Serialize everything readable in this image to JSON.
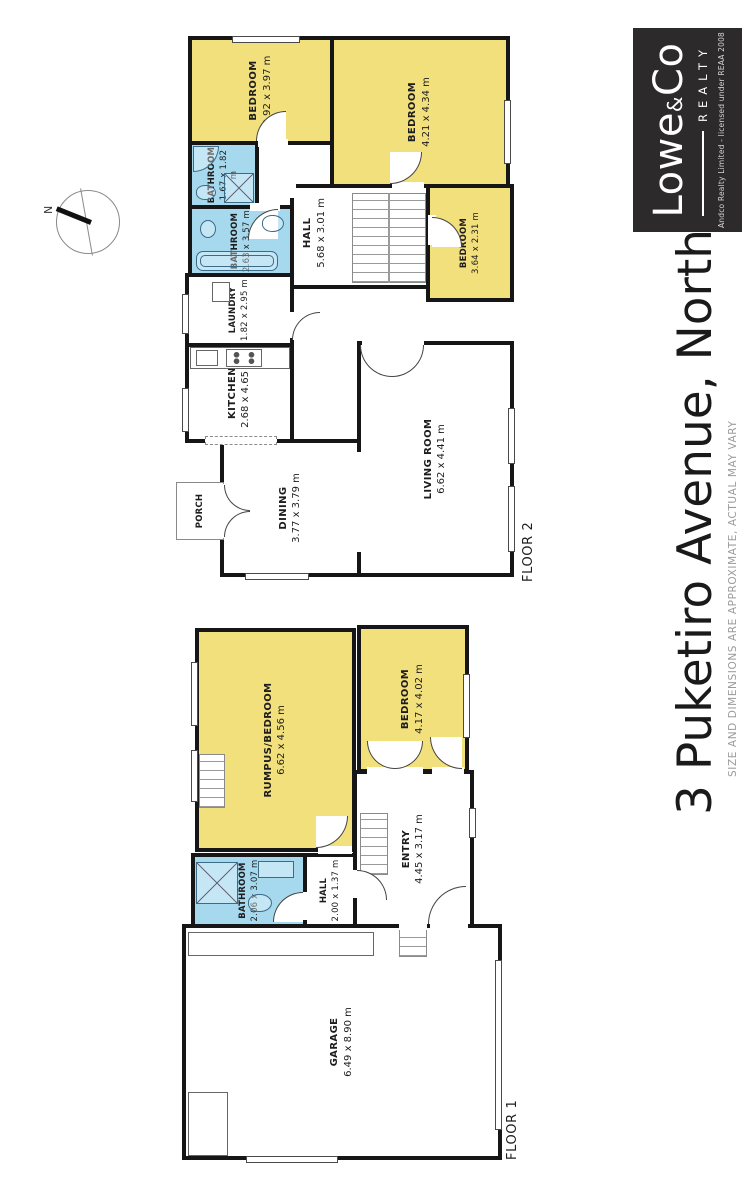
{
  "title": "3 Puketiro Avenue, Northland",
  "disclaimer": "SIZE AND DIMENSIONS ARE APPROXIMATE, ACTUAL MAY VARY",
  "compass": {
    "north": "N"
  },
  "logo": {
    "brand_lowe": "Lowe",
    "brand_amp": "&",
    "brand_co": "Co",
    "realty": "REALTY",
    "license": "Andco Realty Limited - licensed under REAA 2008"
  },
  "colors": {
    "bedroom_yellow": "#F2E07D",
    "bathroom_blue": "#A7D9EE",
    "wall_black": "#161616",
    "logo_background": "#2D2A2B"
  },
  "floor2": {
    "label": "FLOOR 2",
    "rooms": [
      {
        "name": "BEDROOM",
        "dims": "2.92 x 3.97 m"
      },
      {
        "name": "BEDROOM",
        "dims": "4.21 x 4.34 m"
      },
      {
        "name": "BEDROOM",
        "dims": "3.64 x 2.31 m"
      },
      {
        "name": "BATHROOM",
        "dims": "1.67 x 1.82 m"
      },
      {
        "name": "BATHROOM",
        "dims": "2.63 x 3.57 m"
      },
      {
        "name": "HALL",
        "dims": "5.68 x 3.01 m"
      },
      {
        "name": "LAUNDRY",
        "dims": "1.82 x 2.95 m"
      },
      {
        "name": "KITCHEN",
        "dims": "2.68 x 4.65 m"
      },
      {
        "name": "DINING",
        "dims": "3.77 x 3.79 m"
      },
      {
        "name": "LIVING ROOM",
        "dims": "6.62 x 4.41 m"
      },
      {
        "name": "PORCH",
        "dims": ""
      }
    ]
  },
  "floor1": {
    "label": "FLOOR 1",
    "rooms": [
      {
        "name": "RUMPUS/BEDROOM",
        "dims": "6.62 x 4.56 m"
      },
      {
        "name": "BEDROOM",
        "dims": "4.17 x 4.02 m"
      },
      {
        "name": "BATHROOM",
        "dims": "2.06 x 3.07 m"
      },
      {
        "name": "HALL",
        "dims": "2.00 x 1.37 m"
      },
      {
        "name": "ENTRY",
        "dims": "4.45 x 3.17 m"
      },
      {
        "name": "GARAGE",
        "dims": "6.49 x 8.90 m"
      }
    ]
  }
}
